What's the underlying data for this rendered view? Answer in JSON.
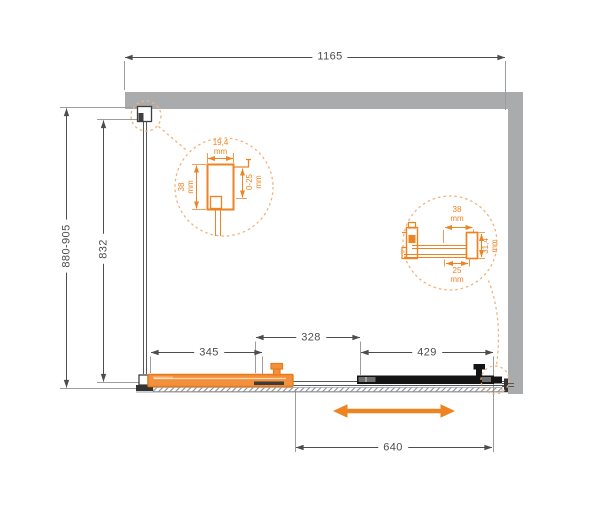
{
  "colors": {
    "accent": "#EE8322",
    "accent-soft": "#F2B27C",
    "panel-fill": "#F2913D",
    "panel-stroke": "#E87A19",
    "wall": "#A9ABAD",
    "line": "#4D4D4D",
    "door": "#141414"
  },
  "dimensions": {
    "overall_width": "1165",
    "overall_height": "880-905",
    "glass_height": "832",
    "fixed_panel_width": "345",
    "overlap_width": "328",
    "door_width": "429",
    "opening_width": "640"
  },
  "detail_left": {
    "profile_width": {
      "value": "19,4",
      "unit": "mm"
    },
    "profile_depth": {
      "value": "38",
      "unit": "mm"
    },
    "adjustment_range": {
      "value": "0-25",
      "unit": "mm"
    }
  },
  "detail_right": {
    "block_width": {
      "value": "38",
      "unit": "mm"
    },
    "block_height": {
      "value": "31,4",
      "unit": "mm"
    },
    "rail_width": {
      "value": "25",
      "unit": "mm"
    }
  }
}
